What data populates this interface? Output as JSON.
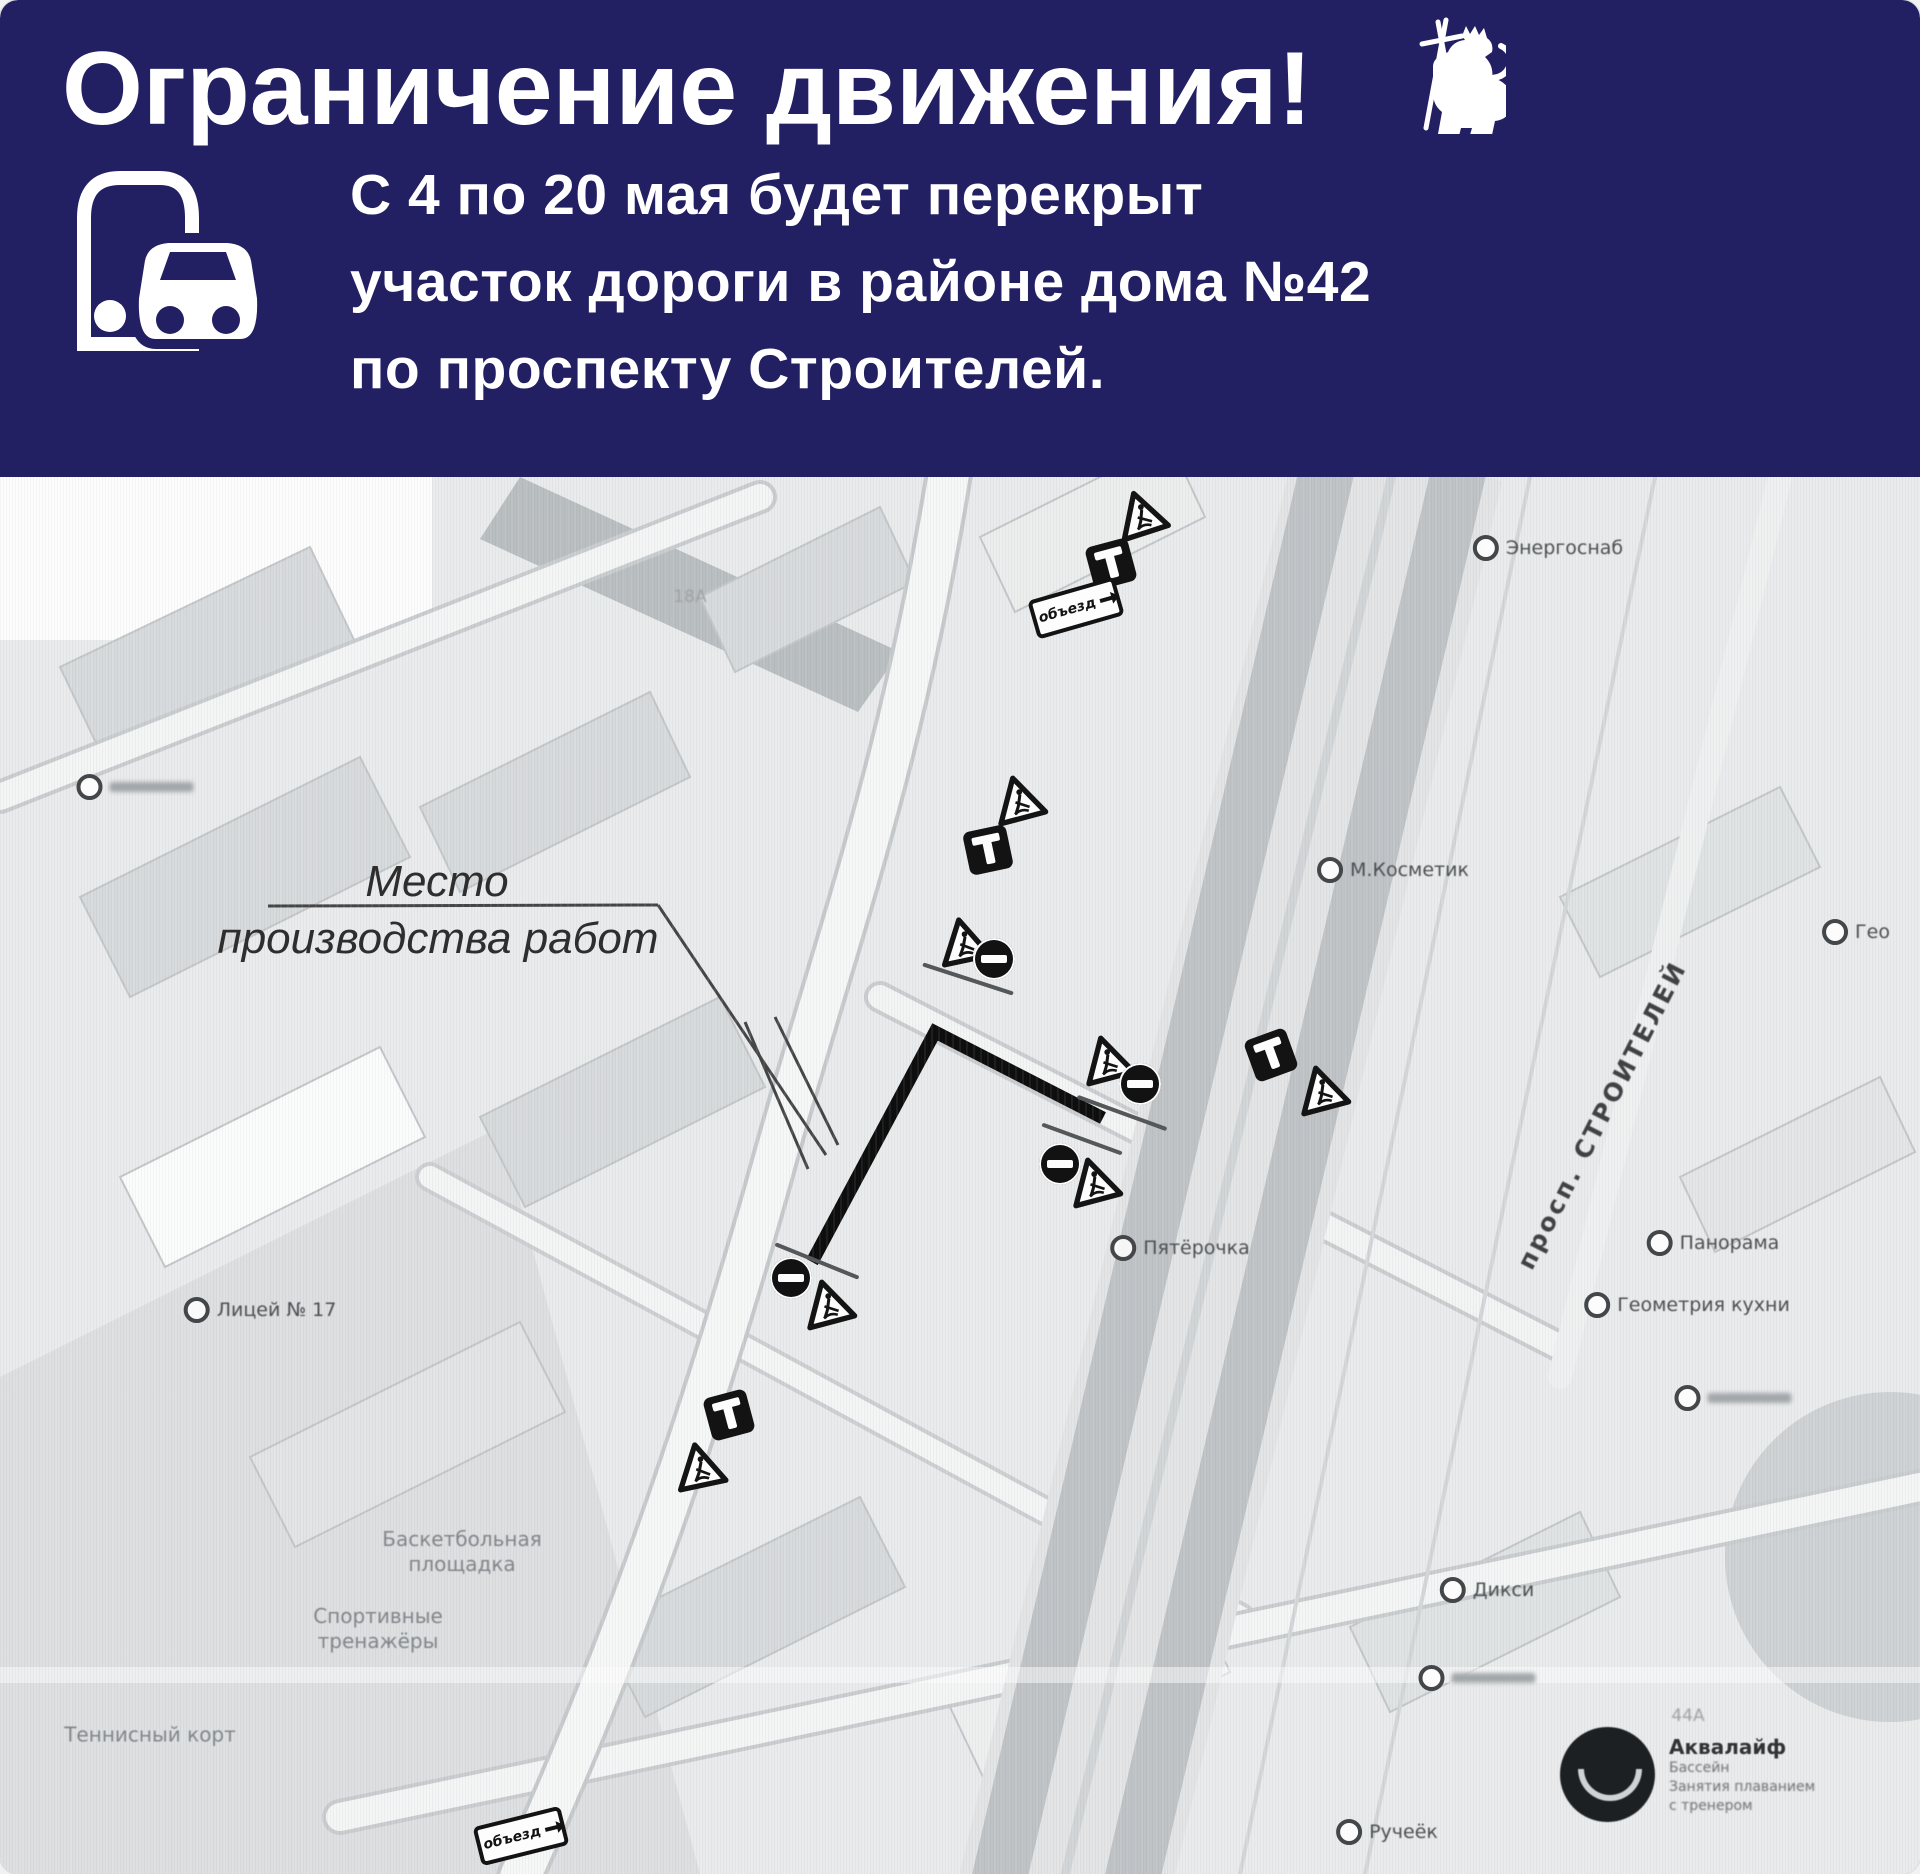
{
  "header": {
    "title": "Ограничение движения!",
    "body_lines": [
      "С 4 по 20 мая будет перекрыт",
      "участок дороги в районе дома №42",
      "по проспекту Строителей."
    ],
    "bg_color": "#221f63",
    "text_color": "#ffffff",
    "icons": [
      "bus-and-car-icon",
      "vladimir-lion-emblem"
    ]
  },
  "map": {
    "callout": {
      "line1": "Место",
      "line2": "производства работ"
    },
    "road_label": "просп. СТРОИТЕЛЕЙ",
    "detour_label": "объезд",
    "aqualife": {
      "name": "Аквалайф",
      "lines": [
        "Бассейн",
        "Занятия плаванием",
        "с тренером"
      ]
    },
    "pois": [
      {
        "name": "poi-energosnab",
        "x": 1548,
        "y": 71,
        "label": "Энергоснаб"
      },
      {
        "name": "poi-m-kosmetik",
        "x": 1393,
        "y": 393,
        "label": "М.Косметик"
      },
      {
        "name": "poi-geo",
        "x": 1856,
        "y": 455,
        "label": "Гео"
      },
      {
        "name": "poi-panorama",
        "x": 1713,
        "y": 766,
        "label": "Панорама"
      },
      {
        "name": "poi-geometriya-kuhni",
        "x": 1687,
        "y": 828,
        "label": "Геометрия кухни"
      },
      {
        "name": "poi-unlabeled-1",
        "x": 1733,
        "y": 921,
        "smudge": true
      },
      {
        "name": "poi-pyaterochka",
        "x": 1180,
        "y": 771,
        "label": "Пятёрочка"
      },
      {
        "name": "poi-diksi",
        "x": 1487,
        "y": 1113,
        "label": "Дикси"
      },
      {
        "name": "poi-unlabeled-2",
        "x": 1477,
        "y": 1201,
        "smudge": true
      },
      {
        "name": "poi-rucheyok",
        "x": 1387,
        "y": 1355,
        "label": "Ручеёк"
      },
      {
        "name": "poi-licey-17",
        "x": 260,
        "y": 833,
        "label": "Лицей № 17"
      },
      {
        "name": "poi-unlabeled-3",
        "x": 135,
        "y": 310,
        "smudge": true
      }
    ],
    "area_labels": [
      {
        "name": "label-basketball",
        "x": 462,
        "y": 1075,
        "lines": [
          "Баскетбольная",
          "площадка"
        ]
      },
      {
        "name": "label-trenazhery",
        "x": 378,
        "y": 1152,
        "lines": [
          "Спортивные",
          "тренажёры"
        ]
      },
      {
        "name": "label-tennis",
        "x": 150,
        "y": 1258,
        "lines": [
          "Теннисный корт"
        ]
      }
    ],
    "house_numbers": [
      {
        "text": "18А",
        "x": 690,
        "y": 120
      },
      {
        "text": "44А",
        "x": 1688,
        "y": 1239
      }
    ],
    "signs": [
      {
        "type": "triangle",
        "x": 1140,
        "y": 36,
        "r": -18
      },
      {
        "type": "deadend",
        "x": 1111,
        "y": 87,
        "r": -15
      },
      {
        "type": "plate",
        "x": 1076,
        "y": 131,
        "r": -16
      },
      {
        "type": "triangle",
        "x": 1018,
        "y": 321,
        "r": -15
      },
      {
        "type": "deadend",
        "x": 988,
        "y": 373,
        "r": -12
      },
      {
        "type": "triangle",
        "x": 963,
        "y": 463,
        "r": -12
      },
      {
        "type": "noentry",
        "x": 994,
        "y": 482,
        "r": 0
      },
      {
        "type": "post",
        "x": 968,
        "y": 502,
        "r": 18,
        "len": 95
      },
      {
        "type": "triangle",
        "x": 1106,
        "y": 581,
        "r": -15
      },
      {
        "type": "noentry",
        "x": 1140,
        "y": 607,
        "r": 0
      },
      {
        "type": "post",
        "x": 1122,
        "y": 636,
        "r": 20,
        "len": 95
      },
      {
        "type": "post",
        "x": 1082,
        "y": 662,
        "r": 20,
        "len": 85
      },
      {
        "type": "noentry",
        "x": 1060,
        "y": 687,
        "r": 0
      },
      {
        "type": "triangle",
        "x": 1093,
        "y": 703,
        "r": -15
      },
      {
        "type": "deadend",
        "x": 1271,
        "y": 578,
        "r": -20
      },
      {
        "type": "triangle",
        "x": 1321,
        "y": 611,
        "r": -15
      },
      {
        "type": "post",
        "x": 817,
        "y": 784,
        "r": 22,
        "len": 90
      },
      {
        "type": "noentry",
        "x": 791,
        "y": 801,
        "r": 0
      },
      {
        "type": "triangle",
        "x": 827,
        "y": 825,
        "r": -15
      },
      {
        "type": "deadend",
        "x": 729,
        "y": 938,
        "r": -15
      },
      {
        "type": "triangle",
        "x": 699,
        "y": 988,
        "r": -12
      },
      {
        "type": "plate",
        "x": 521,
        "y": 1359,
        "r": -14
      }
    ]
  }
}
